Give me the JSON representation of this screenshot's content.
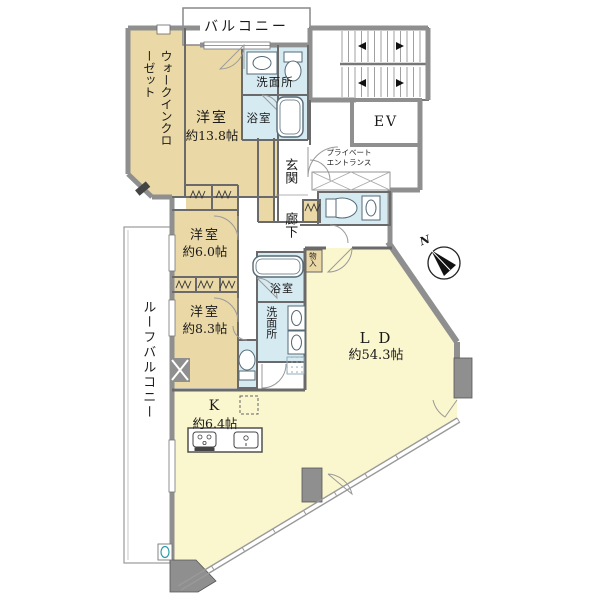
{
  "floorplan": {
    "balcony": {
      "label": "バルコニー"
    },
    "walk_in_closet": {
      "label": "ウォークインクローゼット"
    },
    "bedroom_138": {
      "name": "洋室",
      "size": "約13.8帖"
    },
    "washroom_upper": {
      "label": "洗面所"
    },
    "bathroom_upper": {
      "label": "浴室"
    },
    "stairs": {
      "label": ""
    },
    "elevator": {
      "label": "EV"
    },
    "private_entrance": {
      "line1": "プライベート",
      "line2": "エントランス"
    },
    "entrance": {
      "label": "玄関"
    },
    "corridor": {
      "label": "廊下"
    },
    "bedroom_60": {
      "name": "洋室",
      "size": "約6.0帖"
    },
    "bedroom_83": {
      "name": "洋室",
      "size": "約8.3帖"
    },
    "bathroom_lower": {
      "label": "浴室"
    },
    "washroom_lower": {
      "label": "洗面所"
    },
    "storage": {
      "label": "物入"
    },
    "living_dining": {
      "name": "L D",
      "size": "約54.3帖"
    },
    "kitchen": {
      "name": "K",
      "size": "約6.4帖"
    },
    "roof_balcony": {
      "label": "ルーフバルコニー"
    },
    "compass": {
      "label": "N"
    },
    "colors": {
      "room_beige": "#ead9a6",
      "wet_blue": "#d6eaf2",
      "ldk_yellow": "#faf6ce",
      "wall_gray": "#8f8f8f",
      "line_dark": "#555555"
    }
  }
}
